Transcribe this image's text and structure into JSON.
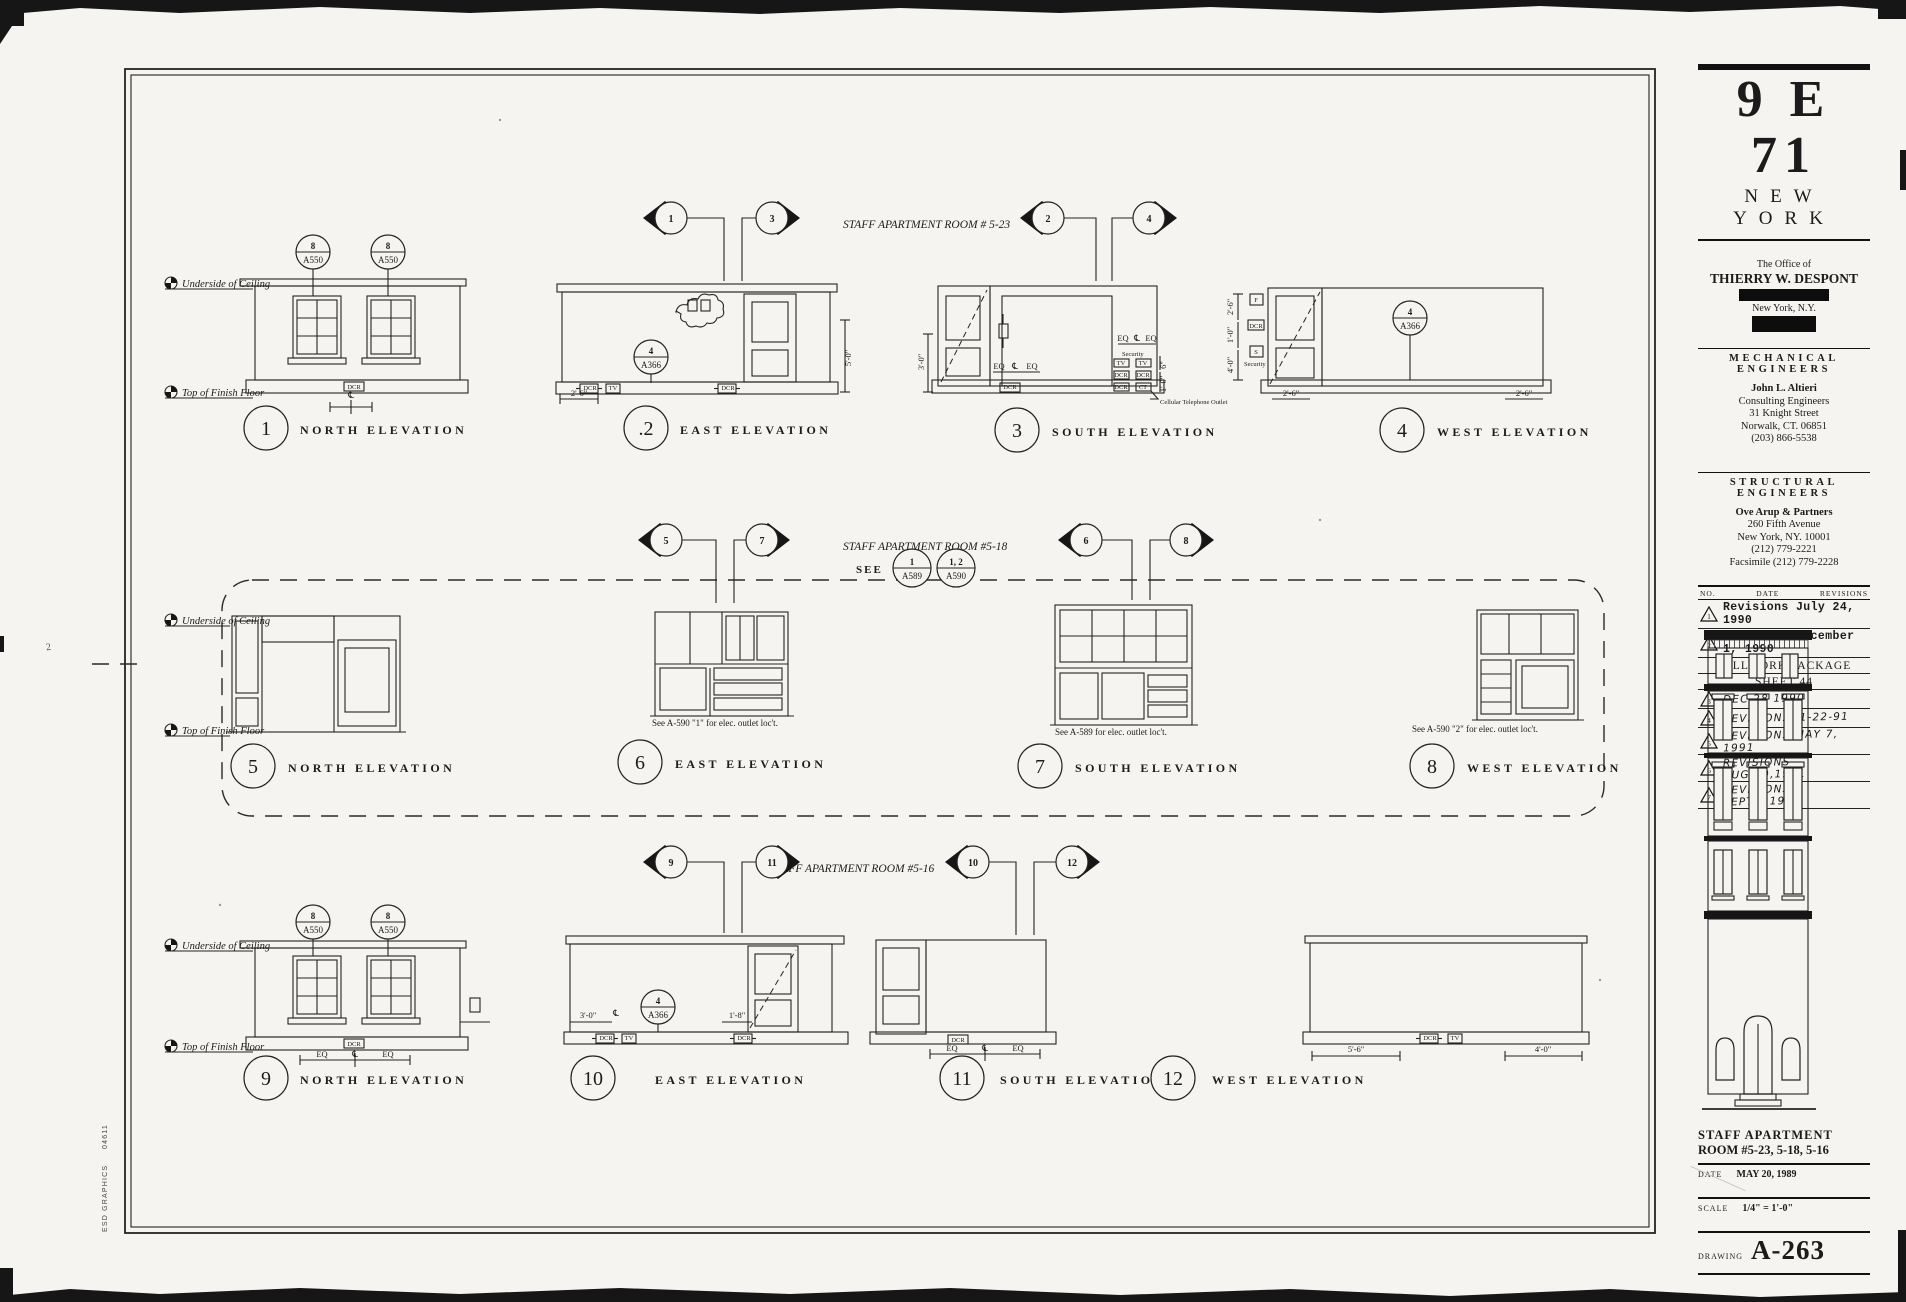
{
  "page": {
    "paper": "#f5f4f0",
    "ink": "#1c1c1c",
    "edge": "#0c0c0c"
  },
  "margin": {
    "credit": "ESD GRAPHICS",
    "credit_code": "04611",
    "stray_mark": "2"
  },
  "ann": {
    "uoc": "Underside of Ceiling",
    "toff": "Top of Finish Floor",
    "see": "SEE",
    "b_a550_t": "8",
    "b_a550_b": "A550",
    "b_a366_t": "4",
    "b_a366_b": "A366",
    "b_a589_t": "1",
    "b_a589_b": "A589",
    "b_a590_t": "1, 2",
    "b_a590_b": "A590",
    "note6": "See A-590 \"1\" for elec. outlet loc't.",
    "note7": "See A-589 for elec. outlet loc't.",
    "note8": "See A-590 \"2\" for elec. outlet loc't.",
    "security": "Security",
    "cellular": "Cellular Telephone Outlet"
  },
  "dims": {
    "d26": "2'-6\"",
    "d50": "5'-0\"",
    "d30": "3'-0\"",
    "d10": "1'-0\"",
    "d40": "4'-0\"",
    "d6": "6\"",
    "d56": "5'-6\"",
    "d18": "1'-8\"",
    "eq": "EQ",
    "cl": "℄",
    "dcr": "DCR",
    "tv": "TV",
    "ct": "CT",
    "f": "F",
    "s": "S"
  },
  "rows": [
    {
      "title": "STAFF APARTMENT ROOM # 5-23",
      "markers": [
        "1",
        "3",
        "2",
        "4"
      ],
      "elevs": [
        {
          "num": "1",
          "name": "NORTH ELEVATION"
        },
        {
          "num": ".2",
          "name": "EAST ELEVATION"
        },
        {
          "num": "3",
          "name": "SOUTH ELEVATION"
        },
        {
          "num": "4",
          "name": "WEST ELEVATION"
        }
      ]
    },
    {
      "title": "STAFF APARTMENT ROOM #5-18",
      "markers": [
        "5",
        "7",
        "6",
        "8"
      ],
      "elevs": [
        {
          "num": "5",
          "name": "NORTH ELEVATION"
        },
        {
          "num": "6",
          "name": "EAST ELEVATION"
        },
        {
          "num": "7",
          "name": "SOUTH ELEVATION"
        },
        {
          "num": "8",
          "name": "WEST ELEVATION"
        }
      ]
    },
    {
      "title": "STAFF APARTMENT ROOM #5-16",
      "markers": [
        "9",
        "11",
        "10",
        "12"
      ],
      "elevs": [
        {
          "num": "9",
          "name": "NORTH ELEVATION"
        },
        {
          "num": "10",
          "name": "EAST ELEVATION"
        },
        {
          "num": "11",
          "name": "SOUTH ELEVATION"
        },
        {
          "num": "12",
          "name": "WEST ELEVATION"
        }
      ]
    }
  ],
  "titleblock": {
    "project": "9 E 71",
    "city": "NEW YORK",
    "office_line": "The Office of",
    "architect": "THIERRY W. DESPONT",
    "address_city": "New York, N.Y.",
    "mech_heading": "MECHANICAL ENGINEERS",
    "mech_lines": [
      "John L. Altieri",
      "Consulting Engineers",
      "31 Knight Street",
      "Norwalk, CT. 06851",
      "(203) 866-5538"
    ],
    "struct_heading": "STRUCTURAL ENGINEERS",
    "struct_lines": [
      "Ove Arup & Partners",
      "260 Fifth Avenue",
      "New York, NY. 10001",
      "(212) 779-2221",
      "Facsimile (212) 779-2228"
    ],
    "rev_header": {
      "no": "NO.",
      "date": "DATE",
      "revisions": "REVISIONS"
    },
    "revisions": [
      {
        "no": "1",
        "text": "Revisions  July 24, 1990",
        "style": "typed"
      },
      {
        "no": "2",
        "text": "Revisions  December 1, 1990",
        "style": "typed"
      },
      {
        "no": "",
        "text": "MILLWORK PACKAGE",
        "style": "center"
      },
      {
        "no": "",
        "text": "SHEET 44",
        "style": "center"
      },
      {
        "no": "3",
        "text": "DEC 28 1990",
        "style": "hand"
      },
      {
        "no": "4",
        "text": "REVISIONS,  1-22-91",
        "style": "hand"
      },
      {
        "no": "5",
        "text": "REVISIONS  MAY 7, 1991",
        "style": "hand"
      },
      {
        "no": "6",
        "text": "REVISIONS  AUG.19,1991",
        "style": "hand"
      },
      {
        "no": "7",
        "text": "REVISIONS  SEPT.6,1991",
        "style": "hand"
      }
    ],
    "sheet_title1": "STAFF APARTMENT",
    "sheet_title2": "ROOM #5-23, 5-18, 5-16",
    "date_label": "DATE",
    "date_value": "MAY 20, 1989",
    "scale_label": "SCALE",
    "scale_value": "1/4\" = 1'-0\"",
    "drawing_label": "DRAWING",
    "drawing_number": "A-263"
  }
}
